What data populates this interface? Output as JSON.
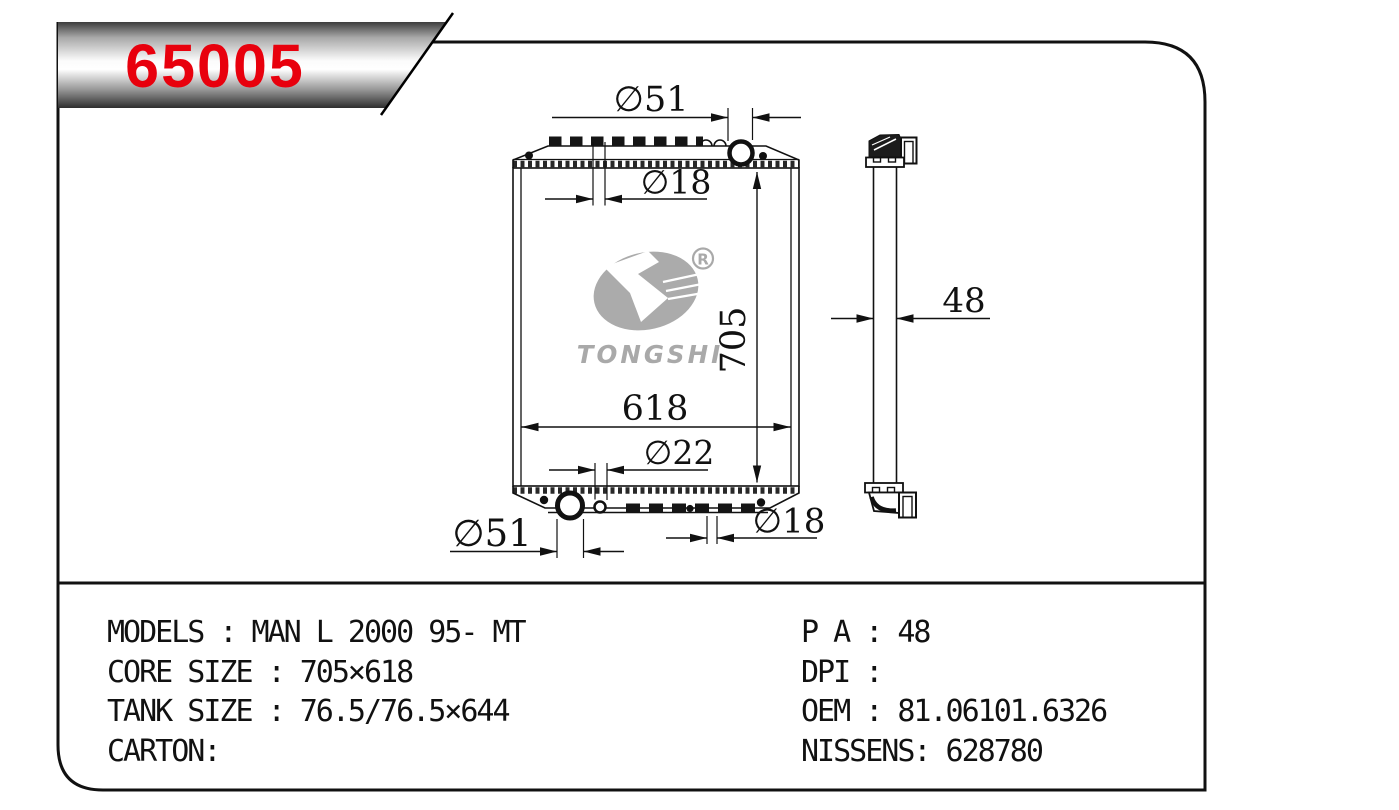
{
  "page": {
    "background": "#ffffff",
    "ink_color": "#111111"
  },
  "badge": {
    "part_number": "65005",
    "text_color": "#e8000d"
  },
  "logo": {
    "brand": "TONGSHI",
    "registered_mark": "R",
    "color": "#a9a9a9"
  },
  "drawing": {
    "front_view": {
      "dim_top_pipe": "∅51",
      "dim_top_small": "∅18",
      "dim_height": "705",
      "dim_width": "618",
      "dim_bottom_small": "∅22",
      "dim_bottom_pipe": "∅51",
      "dim_bottom_right": "∅18"
    },
    "side_view": {
      "dim_thickness": "48"
    }
  },
  "specs": {
    "left_lines": [
      "MODELS : MAN L 2000 95- MT",
      "CORE SIZE : 705×618",
      "TANK SIZE : 76.5/76.5×644",
      "CARTON:"
    ],
    "right_lines": [
      "P A : 48",
      "DPI :",
      "OEM : 81.06101.6326",
      "NISSENS: 628780"
    ]
  }
}
